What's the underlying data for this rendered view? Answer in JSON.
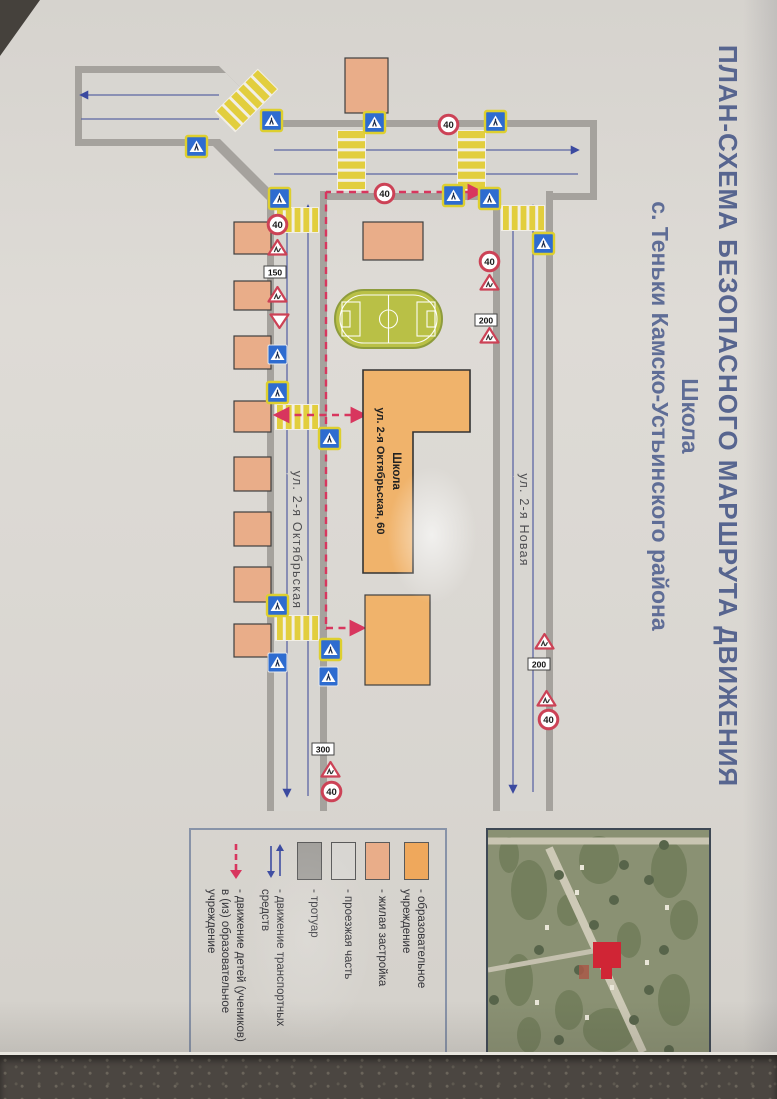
{
  "title": {
    "line1": "ПЛАН-СХЕМА БЕЗОПАСНОГО МАРШРУТА ДВИЖЕНИЯ",
    "line2": "Школа",
    "line3": "с. Теньки Камско-Устьинского района"
  },
  "legend": {
    "items": [
      {
        "swatch": "#efa85c",
        "label": "- образовательное учреждение"
      },
      {
        "swatch": "#e9ad89",
        "label": "- жилая застройка"
      },
      {
        "swatch": "#d8d6d2",
        "label": "- проезжая часть"
      },
      {
        "swatch": "#a2a09c",
        "label": "- тротуар"
      },
      {
        "icon": "blue-arrows",
        "label": "- движение транспортных средств"
      },
      {
        "icon": "red-dashed-arrow",
        "label": "- движение детей (учеников) в (из) образовательное учреждение"
      }
    ]
  },
  "map": {
    "street_a_label": {
      "text": "ул. 2-я Октябрьская",
      "x": 540,
      "y": 484
    },
    "street_b_label": {
      "text": "ул. 2-я Новая",
      "x": 520,
      "y": 257
    },
    "school": {
      "line1": "Школа",
      "line2": "ул. 2-я Октябрьская, 60",
      "path": "M370,307 L432,307 L432,364 L573,364 L573,414 L370,414 Z",
      "label_x": 471,
      "label_y1": 384,
      "label_y2": 400
    },
    "colors": {
      "road": "#d8d6d1",
      "sidewalk": "#a5a29d",
      "zebra_yellow": "#e2ce3e",
      "zebra_base": "#f2efe6",
      "residential": "#e9ad89",
      "education": "#f0b36b",
      "route": "#d8365e",
      "traffic": "#3b4aa0",
      "sign_blue": "#2e6cd0",
      "sign_yellow": "#ddcf2f",
      "sign_red": "#cc4256",
      "field": "#b9c046",
      "field_line": "#ffffff"
    },
    "roadM": {
      "outer": "M120,180 L200,180 L200,510 L146,564 L146,702 L66,702 L66,558 L120,504 Z",
      "inner": "M127,187 L193,187 L193,503 L139,557 L139,695 L73,695 L73,551 L127,497 Z"
    },
    "roadA": {
      "outer": {
        "x": 191,
        "y": 450,
        "w": 620,
        "h": 60
      },
      "inner": {
        "x": 191,
        "y": 457,
        "w": 620,
        "h": 46
      }
    },
    "roadB": {
      "outer": {
        "x": 191,
        "y": 224,
        "w": 620,
        "h": 60
      },
      "inner": {
        "x": 191,
        "y": 231,
        "w": 620,
        "h": 46
      }
    },
    "lanes": [
      {
        "x1": 150,
        "y1": 199,
        "x2": 150,
        "y2": 503,
        "arrow": "start"
      },
      {
        "x1": 174,
        "y1": 199,
        "x2": 174,
        "y2": 503,
        "arrow": "none"
      },
      {
        "x1": 95,
        "y1": 558,
        "x2": 95,
        "y2": 696,
        "arrow": "end"
      },
      {
        "x1": 119,
        "y1": 558,
        "x2": 119,
        "y2": 696,
        "arrow": "none"
      },
      {
        "x1": 206,
        "y1": 469,
        "x2": 796,
        "y2": 469,
        "arrow": "start"
      },
      {
        "x1": 206,
        "y1": 490,
        "x2": 796,
        "y2": 490,
        "arrow": "end"
      },
      {
        "x1": 206,
        "y1": 244,
        "x2": 792,
        "y2": 244,
        "arrow": "start"
      },
      {
        "x1": 206,
        "y1": 264,
        "x2": 792,
        "y2": 264,
        "arrow": "end"
      }
    ],
    "zebras": [
      {
        "x": 205,
        "y": 232,
        "w": 26,
        "h": 44,
        "bars": "h"
      },
      {
        "x": 207,
        "y": 458,
        "w": 26,
        "h": 44,
        "bars": "h"
      },
      {
        "x": 404,
        "y": 458,
        "w": 26,
        "h": 44,
        "bars": "h"
      },
      {
        "x": 615,
        "y": 458,
        "w": 26,
        "h": 44,
        "bars": "h"
      },
      {
        "x": 130,
        "y": 291,
        "w": 61,
        "h": 29,
        "bars": "v"
      },
      {
        "x": 130,
        "y": 411,
        "w": 61,
        "h": 29,
        "bars": "v"
      },
      {
        "x": 70,
        "y": 516,
        "w": 61,
        "h": 29,
        "bars": "v",
        "rot": 45
      }
    ],
    "routes": [
      {
        "d": "M192,296 L192,451",
        "arrows": "start"
      },
      {
        "d": "M192,451 L630,451",
        "arrows": "none"
      },
      {
        "d": "M415,413 L415,501",
        "arrows": "both"
      },
      {
        "d": "M628,451 L628,414",
        "arrows": "end"
      }
    ],
    "buildings": [
      {
        "x": 222,
        "y": 506,
        "w": 32,
        "h": 37,
        "type": "res"
      },
      {
        "x": 281,
        "y": 506,
        "w": 29,
        "h": 37,
        "type": "res"
      },
      {
        "x": 336,
        "y": 506,
        "w": 33,
        "h": 37,
        "type": "res"
      },
      {
        "x": 401,
        "y": 506,
        "w": 31,
        "h": 37,
        "type": "res"
      },
      {
        "x": 457,
        "y": 506,
        "w": 34,
        "h": 37,
        "type": "res"
      },
      {
        "x": 512,
        "y": 506,
        "w": 34,
        "h": 37,
        "type": "res"
      },
      {
        "x": 567,
        "y": 506,
        "w": 35,
        "h": 37,
        "type": "res"
      },
      {
        "x": 624,
        "y": 506,
        "w": 33,
        "h": 37,
        "type": "res"
      },
      {
        "x": 58,
        "y": 389,
        "w": 55,
        "h": 43,
        "type": "res"
      },
      {
        "x": 222,
        "y": 354,
        "w": 38,
        "h": 60,
        "type": "res"
      },
      {
        "x": 595,
        "y": 347,
        "w": 90,
        "h": 65,
        "type": "edu"
      }
    ],
    "field": {
      "x": 290,
      "y": 335,
      "w": 58,
      "h": 107
    },
    "signs": [
      {
        "t": "cw",
        "x": 188,
        "y": 487
      },
      {
        "t": "s40",
        "x": 214,
        "y": 489,
        "label": "40"
      },
      {
        "t": "tri",
        "x": 237,
        "y": 489
      },
      {
        "t": "plate",
        "x": 261,
        "y": 492,
        "label": "150"
      },
      {
        "t": "tri",
        "x": 284,
        "y": 489
      },
      {
        "t": "yield",
        "x": 310,
        "y": 487
      },
      {
        "t": "cwp",
        "x": 344,
        "y": 489
      },
      {
        "t": "cw",
        "x": 382,
        "y": 489
      },
      {
        "t": "cw",
        "x": 428,
        "y": 437
      },
      {
        "t": "cw",
        "x": 595,
        "y": 489
      },
      {
        "t": "cwp",
        "x": 652,
        "y": 489
      },
      {
        "t": "cw",
        "x": 639,
        "y": 436
      },
      {
        "t": "cwp",
        "x": 666,
        "y": 438
      },
      {
        "t": "plate",
        "x": 738,
        "y": 444,
        "label": "300"
      },
      {
        "t": "tri",
        "x": 759,
        "y": 436
      },
      {
        "t": "s40",
        "x": 781,
        "y": 435,
        "label": "40"
      },
      {
        "t": "cw",
        "x": 188,
        "y": 277
      },
      {
        "t": "cw",
        "x": 233,
        "y": 223
      },
      {
        "t": "s40",
        "x": 251,
        "y": 277,
        "label": "40"
      },
      {
        "t": "tri",
        "x": 272,
        "y": 277
      },
      {
        "t": "plate",
        "x": 309,
        "y": 281,
        "label": "200"
      },
      {
        "t": "tri",
        "x": 325,
        "y": 277
      },
      {
        "t": "tri",
        "x": 631,
        "y": 222
      },
      {
        "t": "plate",
        "x": 653,
        "y": 228,
        "label": "200"
      },
      {
        "t": "tri",
        "x": 688,
        "y": 220
      },
      {
        "t": "s40",
        "x": 709,
        "y": 218,
        "label": "40"
      },
      {
        "t": "cw",
        "x": 111,
        "y": 271
      },
      {
        "t": "s40",
        "x": 114,
        "y": 318,
        "label": "40"
      },
      {
        "t": "cw",
        "x": 112,
        "y": 392
      },
      {
        "t": "s40",
        "x": 183,
        "y": 382,
        "label": "40"
      },
      {
        "t": "cw",
        "x": 185,
        "y": 313
      },
      {
        "t": "cw",
        "x": 136,
        "y": 570
      },
      {
        "t": "cw",
        "x": 110,
        "y": 495
      }
    ]
  }
}
